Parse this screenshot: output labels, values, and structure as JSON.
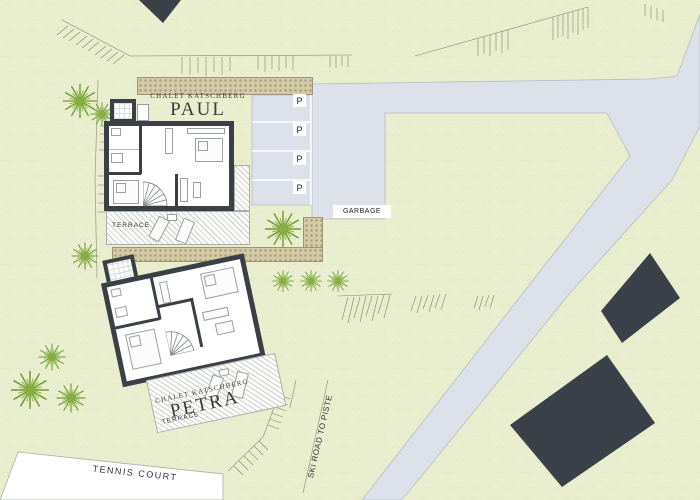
{
  "chalets": {
    "paul": {
      "brand": "CHALET KATSCHBERG",
      "name": "PAUL",
      "terrace": "TERRACE"
    },
    "petra": {
      "brand": "CHALET KATSCHBERG",
      "name": "PETRA",
      "terrace": "TERRACE"
    }
  },
  "parking": {
    "spaces": [
      "P",
      "P",
      "P",
      "P"
    ]
  },
  "labels": {
    "garbage": "GARBAGE",
    "tennis_court": "TENNIS COURT",
    "ski_road": "SKI ROAD TO PISTE"
  },
  "colors": {
    "ground": "#e9eecf",
    "road": "#dde1e9",
    "cobble_path": "#d2cba6",
    "neighbor_building": "#3a4148",
    "chalet_wall": "#3a4046",
    "tree": "#6e9a2e",
    "tennis_court": "#ffffff"
  }
}
